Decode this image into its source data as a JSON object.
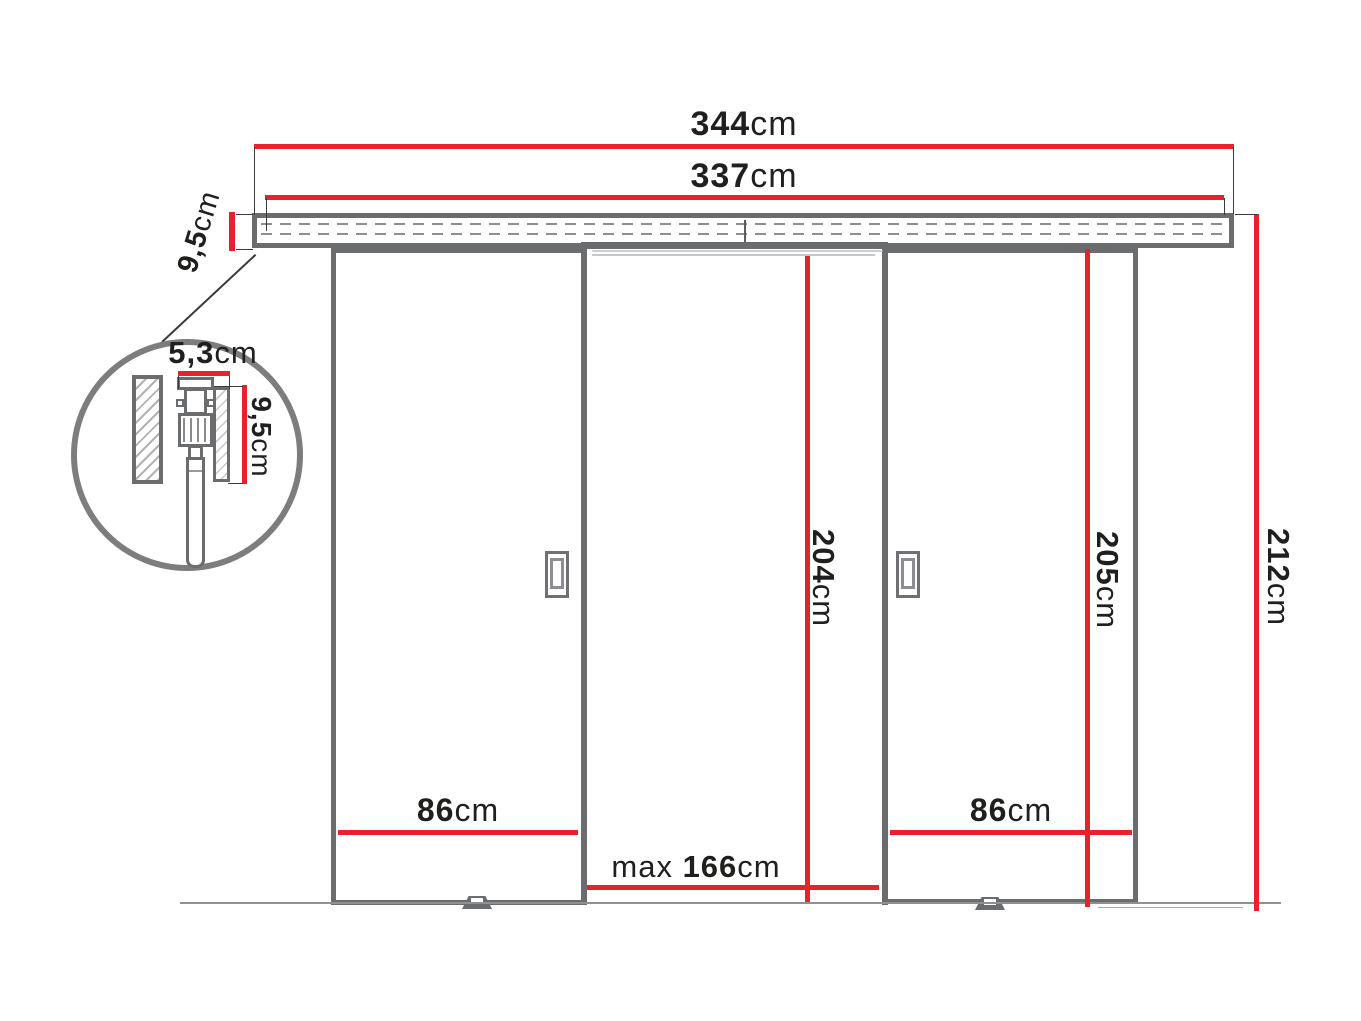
{
  "dimensions": {
    "total_width": {
      "value": "344",
      "unit": "cm"
    },
    "track_width": {
      "value": "337",
      "unit": "cm"
    },
    "track_height": {
      "value": "9,5",
      "unit": "cm"
    },
    "opening_height": {
      "value": "204",
      "unit": "cm"
    },
    "door_height": {
      "value": "205",
      "unit": "cm"
    },
    "total_height": {
      "value": "212",
      "unit": "cm"
    },
    "door_left_width": {
      "value": "86",
      "unit": "cm"
    },
    "door_right_width": {
      "value": "86",
      "unit": "cm"
    },
    "opening_width": {
      "prefix": "max ",
      "value": "166",
      "unit": "cm"
    },
    "detail_track_width": {
      "value": "5,3",
      "unit": "cm"
    },
    "detail_track_height": {
      "value": "9,5",
      "unit": "cm"
    }
  },
  "colors": {
    "dimension_red": "#e8222a",
    "structure_grey": "#6b6c6e",
    "text": "#1f1f1d"
  }
}
